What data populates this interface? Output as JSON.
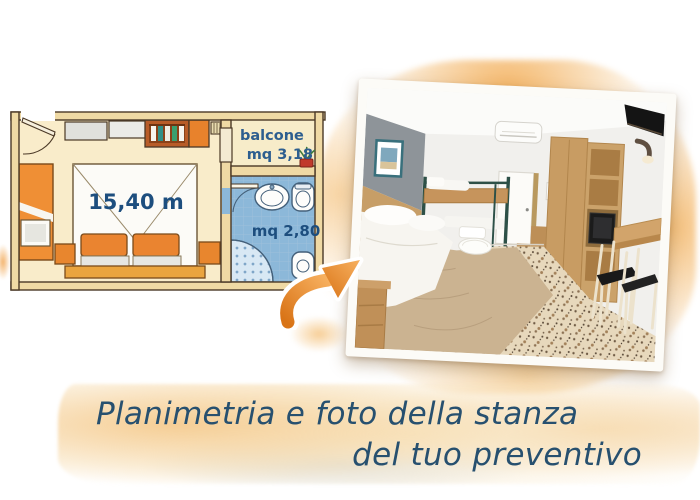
{
  "floor_plan": {
    "room_area_label": "15,40 m",
    "balcony_label": "balcone",
    "balcony_area_label": "mq 3,18",
    "bathroom_area_label": "mq 2,80"
  },
  "caption": {
    "line1": "Planimetria e foto della stanza",
    "line2": "del tuo preventivo"
  },
  "colors": {
    "accent_orange": "#E8862E",
    "plan_label_blue": "#1D4E7E",
    "caption_blue": "#27506F",
    "bathroom_blue": "#8CB8D9",
    "watercolor_peach": "#F4C389"
  },
  "icons": {
    "arrow": "orange-brush-arrow",
    "balcony_plant": "potted-plant"
  }
}
